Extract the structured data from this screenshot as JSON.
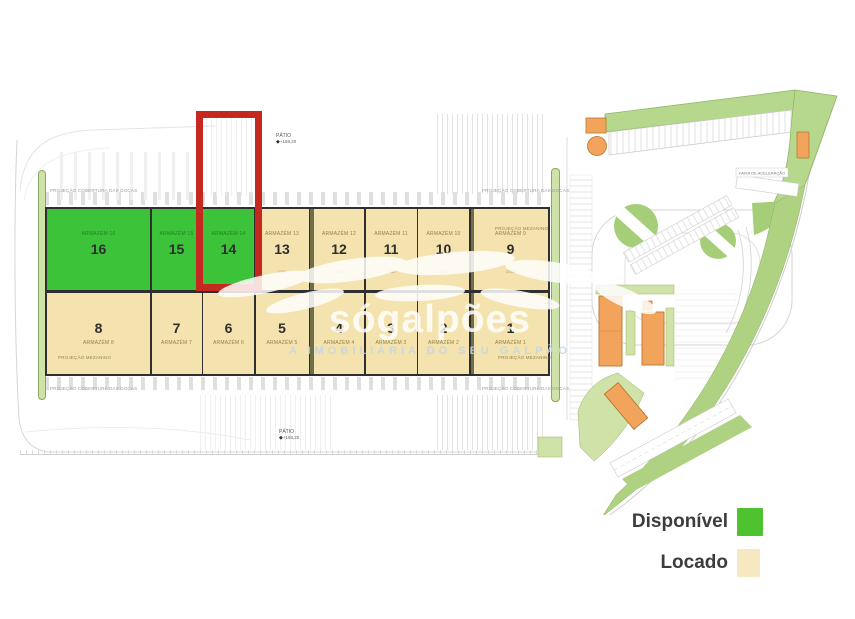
{
  "legend": {
    "items": [
      {
        "key": "available",
        "label": "Disponível",
        "color": "#4ec22f"
      },
      {
        "key": "leased",
        "label": "Locado",
        "color": "#f6e8bf"
      }
    ]
  },
  "watermark": {
    "brand": "sógalpões",
    "tagline": "A IMOBILIÁRIA DO SEU GALPÃO"
  },
  "plan": {
    "colors": {
      "available": "#3cc33a",
      "leased": "#f4e3ae",
      "highlight": "#c5281e",
      "landscape": "#cfe3a8",
      "landscape_dark": "#a6ce79",
      "building_orange": "#f2a45c"
    },
    "highlight_unit": "14",
    "units_top": [
      {
        "num": "16",
        "label": "ARMAZÉM 16",
        "status": "available"
      },
      {
        "num": "15",
        "label": "ARMAZÉM 15",
        "status": "available"
      },
      {
        "num": "14",
        "label": "ARMAZÉM 14",
        "status": "available"
      },
      {
        "num": "13",
        "label": "ARMAZÉM 13",
        "status": "leased",
        "dim": "2250"
      },
      {
        "num": "12",
        "label": "ARMAZÉM 12",
        "status": "leased",
        "dim": "2250"
      },
      {
        "num": "11",
        "label": "ARMAZÉM 11",
        "status": "leased",
        "dim": "2250"
      },
      {
        "num": "10",
        "label": "ARMAZÉM 10",
        "status": "leased",
        "dim": "2250"
      },
      {
        "num": "9",
        "label": "ARMAZÉM 9",
        "status": "leased",
        "dim": "2250"
      }
    ],
    "units_bottom": [
      {
        "num": "8",
        "label": "ARMAZÉM 8",
        "status": "leased"
      },
      {
        "num": "7",
        "label": "ARMAZÉM 7",
        "status": "leased"
      },
      {
        "num": "6",
        "label": "ARMAZÉM 6",
        "status": "leased"
      },
      {
        "num": "5",
        "label": "ARMAZÉM 5",
        "status": "leased"
      },
      {
        "num": "4",
        "label": "ARMAZÉM 4",
        "status": "leased"
      },
      {
        "num": "3",
        "label": "ARMAZÉM 3",
        "status": "leased"
      },
      {
        "num": "2",
        "label": "ARMAZÉM 2",
        "status": "leased"
      },
      {
        "num": "1",
        "label": "ARMAZÉM 1",
        "status": "leased"
      }
    ],
    "annotations": {
      "docks": "PROJEÇÃO COBERTURA DAS DOCAS",
      "mezzanine": "PROJEÇÃO MEZANINO",
      "patio": "PÁTIO",
      "patio_top_elev": "+168,20",
      "patio_bottom_elev": "+168,25",
      "accel_lane": "FAIXA DE ACELERAÇÃO"
    }
  }
}
